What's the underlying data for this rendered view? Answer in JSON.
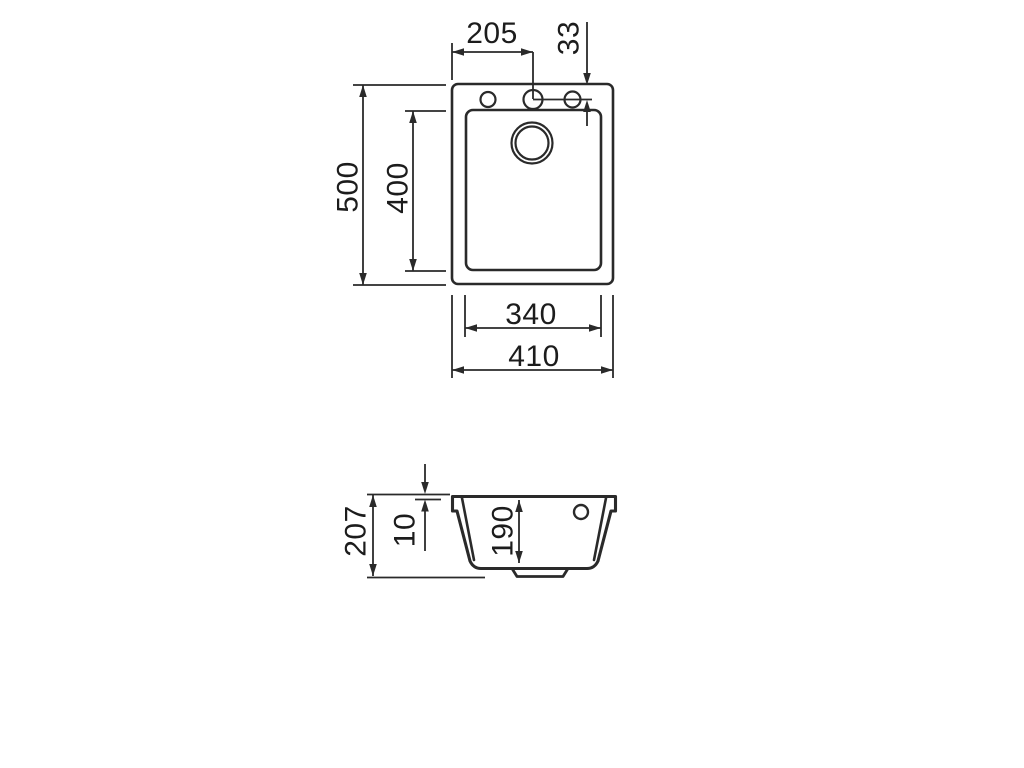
{
  "drawing": {
    "top_view": {
      "dimensions": {
        "hole_center_offset": "205",
        "hole_edge_offset": "33",
        "outer_depth": "500",
        "bowl_depth": "400",
        "bowl_width": "340",
        "outer_width": "410"
      }
    },
    "section_view": {
      "dimensions": {
        "overall_height": "207",
        "rim_thickness": "10",
        "bowl_inner_depth": "190"
      }
    }
  }
}
